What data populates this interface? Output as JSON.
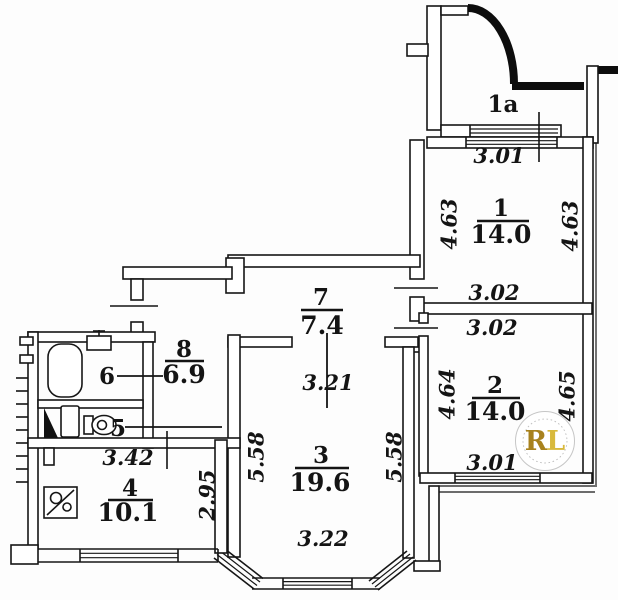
{
  "plan": {
    "type": "apartment floor plan (scan)"
  },
  "rooms": {
    "balcony": {
      "number": "1a"
    },
    "r1": {
      "number": "1",
      "area": "14.0",
      "dim_top": "3.01",
      "dim_left": "4.63",
      "dim_right": "4.63",
      "dim_bottom": "3.02"
    },
    "r2": {
      "number": "2",
      "area": "14.0",
      "dim_top": "3.02",
      "dim_left": "4.64",
      "dim_right": "4.65",
      "dim_bottom": "3.01"
    },
    "r3": {
      "number": "3",
      "area": "19.6",
      "dim_left": "5.58",
      "dim_right": "5.58",
      "dim_bottom": "3.22"
    },
    "r4": {
      "number": "4",
      "area": "10.1",
      "dim_top": "3.42",
      "dim_right": "2.95"
    },
    "r5": {
      "number": "5"
    },
    "r6": {
      "number": "6"
    },
    "r7": {
      "number": "7",
      "area": "7.4",
      "dim_below": "3.21"
    },
    "r8": {
      "number": "8",
      "area": "6.9"
    }
  },
  "watermark": {
    "letter_r": "R",
    "letter_l": "L",
    "color_r": "#a8821e",
    "color_l": "#d8b93c"
  },
  "colors": {
    "background": "#fdfdfd",
    "line": "#161616"
  }
}
